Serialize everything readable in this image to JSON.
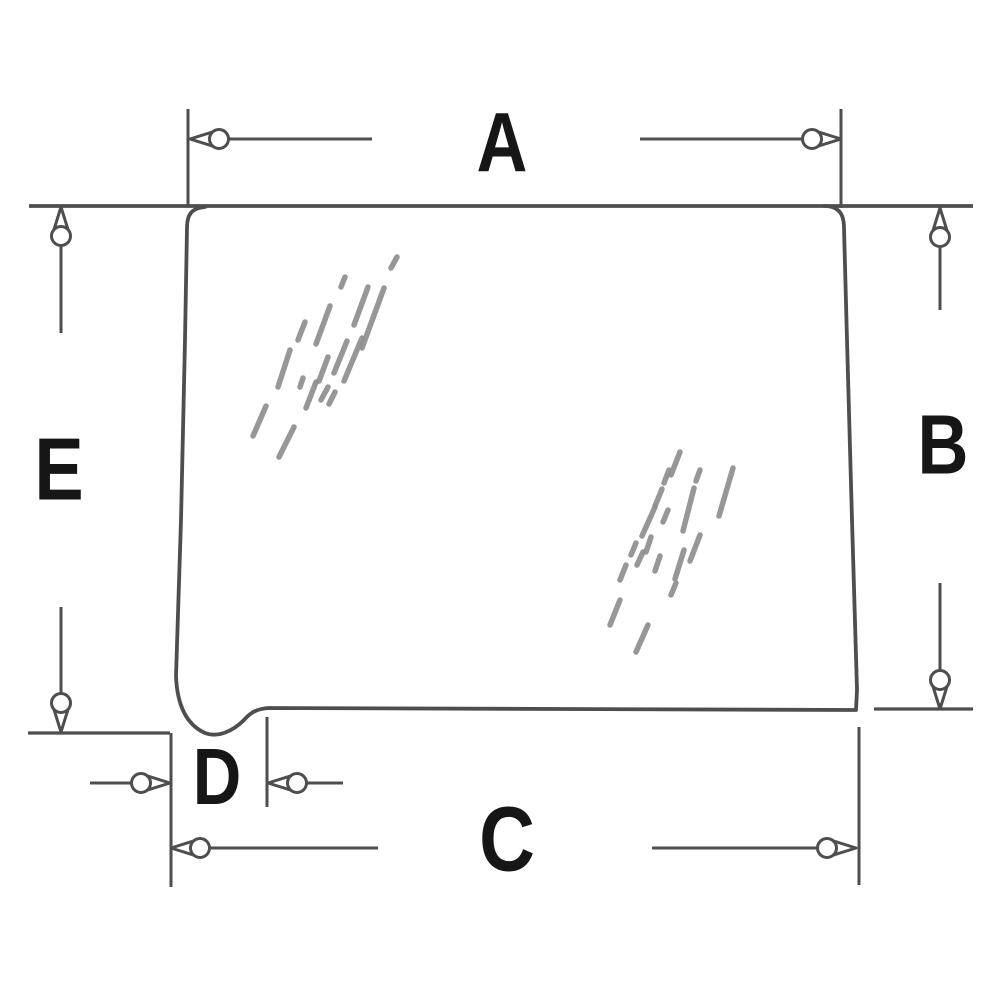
{
  "diagram": {
    "description": "Technical dimension diagram of a cab glass panel with rounded corners, a notched lower-left corner, and five dimension callouts",
    "canvas": {
      "width": 1000,
      "height": 1000,
      "background": "#ffffff"
    },
    "colors": {
      "line": "#4e4e4e",
      "label": "#161616",
      "hatch": "#8f8f8f",
      "arrow_fill": "#ffffff"
    },
    "dimension_labels": [
      {
        "id": "A",
        "text": "A",
        "x": 502,
        "y": 146,
        "size": 84
      },
      {
        "id": "B",
        "text": "B",
        "x": 943,
        "y": 448,
        "size": 84
      },
      {
        "id": "C",
        "text": "C",
        "x": 507,
        "y": 843,
        "size": 92
      },
      {
        "id": "D",
        "text": "D",
        "x": 217,
        "y": 780,
        "size": 80
      },
      {
        "id": "E",
        "text": "E",
        "x": 59,
        "y": 473,
        "size": 88
      }
    ],
    "glass_outline": "M 205 207 C 192 208 187 214 187 228 L 185 340 L 181 520 L 176 676 C 177 702 185 724 205 733 C 218 738 233 731 244 720 C 251 712 257 709 268 708 L 560 709 L 856 710 L 857 690 L 852 520 L 847 340 L 844 228 C 844 213 838 206 824 206",
    "extension_lines": [
      {
        "name": "top-edge-extension-line",
        "p": [
          29,
          206,
          973,
          206
        ],
        "w": 3.8
      },
      {
        "name": "ext-line-a-left",
        "p": [
          188,
          109,
          188,
          206
        ],
        "w": 3.0
      },
      {
        "name": "ext-line-a-right",
        "p": [
          841,
          109,
          841,
          208
        ],
        "w": 3.0
      },
      {
        "name": "ext-line-e-bottom",
        "p": [
          28,
          733,
          170,
          733
        ],
        "w": 3.2
      },
      {
        "name": "ext-line-cd-left",
        "p": [
          171,
          733,
          171,
          887
        ],
        "w": 3.0
      },
      {
        "name": "ext-line-d-right",
        "p": [
          267,
          717,
          267,
          807
        ],
        "w": 3.0
      },
      {
        "name": "ext-line-bottom-right",
        "p": [
          874,
          709,
          973,
          709
        ],
        "w": 3.2
      },
      {
        "name": "ext-line-c-right",
        "p": [
          859,
          727,
          859,
          885
        ],
        "w": 3.0
      }
    ],
    "arrows": [
      {
        "name": "dim-a-left-arrow",
        "x": 190,
        "y": 139,
        "angle": 180,
        "len": 182
      },
      {
        "name": "dim-a-right-arrow",
        "x": 841,
        "y": 139,
        "angle": 0,
        "len": 201
      },
      {
        "name": "dim-b-top-arrow",
        "x": 940,
        "y": 208,
        "angle": -90,
        "len": 102
      },
      {
        "name": "dim-b-bottom-arrow",
        "x": 940,
        "y": 709,
        "angle": 90,
        "len": 126
      },
      {
        "name": "dim-e-top-arrow",
        "x": 61,
        "y": 207,
        "angle": -90,
        "len": 126
      },
      {
        "name": "dim-e-bottom-arrow",
        "x": 61,
        "y": 732,
        "angle": 90,
        "len": 125
      },
      {
        "name": "dim-d-left-arrow",
        "x": 170,
        "y": 783,
        "angle": 0,
        "len": 80
      },
      {
        "name": "dim-d-right-arrow",
        "x": 268,
        "y": 783,
        "angle": 180,
        "len": 75
      },
      {
        "name": "dim-c-left-arrow",
        "x": 171,
        "y": 848,
        "angle": 180,
        "len": 207
      },
      {
        "name": "dim-c-right-arrow",
        "x": 856,
        "y": 848,
        "angle": 0,
        "len": 204
      }
    ],
    "hatch_groups": [
      {
        "name": "glass-shine-upper-left",
        "segments": [
          [
            391,
            268,
            397,
            257
          ],
          [
            368,
            287,
            354,
            325
          ],
          [
            384,
            288,
            362,
            348
          ],
          [
            341,
            287,
            345,
            277
          ],
          [
            330,
            306,
            316,
            344
          ],
          [
            305,
            322,
            298,
            340
          ],
          [
            362,
            338,
            344,
            381
          ],
          [
            347,
            341,
            334,
            373
          ],
          [
            328,
            357,
            319,
            381
          ],
          [
            290,
            350,
            278,
            387
          ],
          [
            303,
            378,
            300,
            387
          ],
          [
            316,
            382,
            306,
            408
          ],
          [
            328,
            387,
            321,
            400
          ],
          [
            335,
            392,
            329,
            404
          ],
          [
            266,
            406,
            253,
            436
          ],
          [
            294,
            427,
            279,
            457
          ]
        ]
      },
      {
        "name": "glass-shine-center-right",
        "segments": [
          [
            680,
            452,
            671,
            475
          ],
          [
            669,
            470,
            664,
            483
          ],
          [
            700,
            470,
            696,
            481
          ],
          [
            733,
            468,
            719,
            516
          ],
          [
            662,
            489,
            655,
            506
          ],
          [
            694,
            488,
            683,
            531
          ],
          [
            655,
            507,
            642,
            536
          ],
          [
            668,
            510,
            663,
            522
          ],
          [
            651,
            537,
            646,
            552
          ],
          [
            636,
            543,
            631,
            555
          ],
          [
            700,
            535,
            690,
            561
          ],
          [
            643,
            552,
            637,
            565
          ],
          [
            684,
            550,
            675,
            579
          ],
          [
            626,
            565,
            620,
            580
          ],
          [
            660,
            556,
            655,
            571
          ],
          [
            676,
            583,
            671,
            595
          ],
          [
            620,
            600,
            610,
            625
          ],
          [
            648,
            625,
            636,
            652
          ]
        ]
      }
    ]
  }
}
